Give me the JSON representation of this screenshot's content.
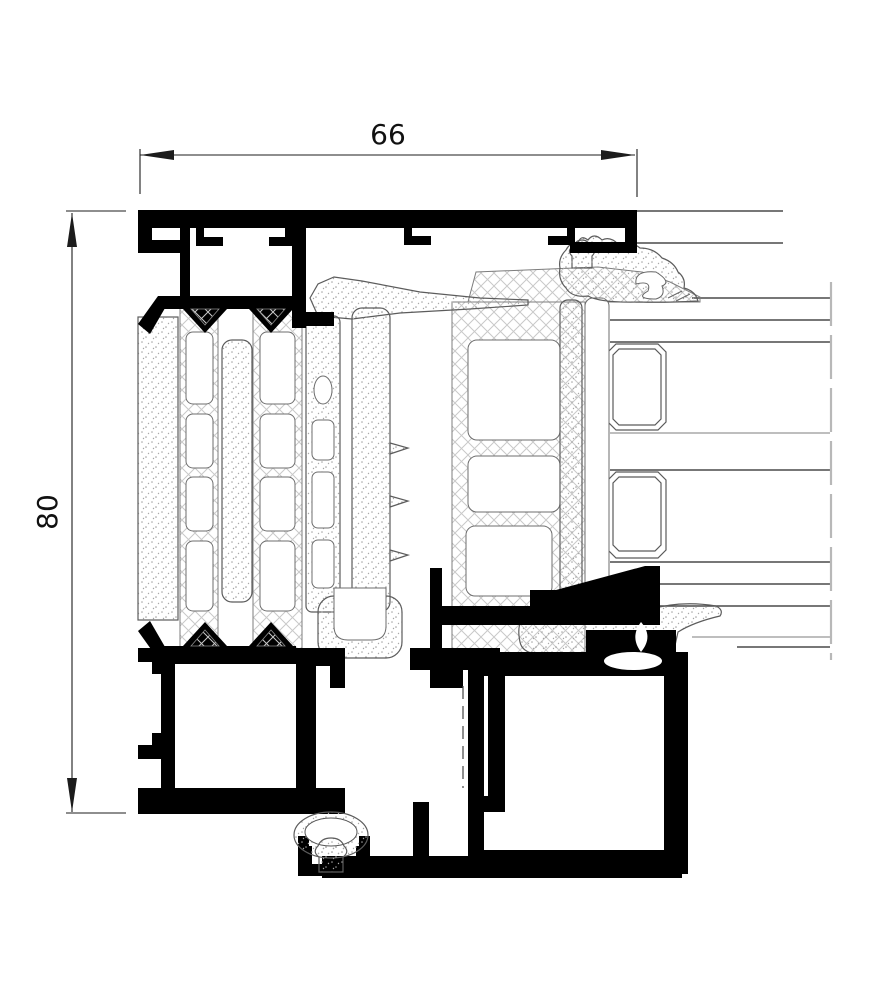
{
  "drawing": {
    "dimensions": {
      "width_mm": "66",
      "height_mm": "80"
    },
    "colors": {
      "aluminium_profile": "#000000",
      "edge_outline": "#4a4a4a",
      "crosshatch_thermal_break": "#c9c9c9",
      "stipple_gasket": "#a3a3a3",
      "dimension_lines": "#1c1c1c",
      "break_line": "#b8b8b8",
      "background": "#ffffff"
    }
  }
}
